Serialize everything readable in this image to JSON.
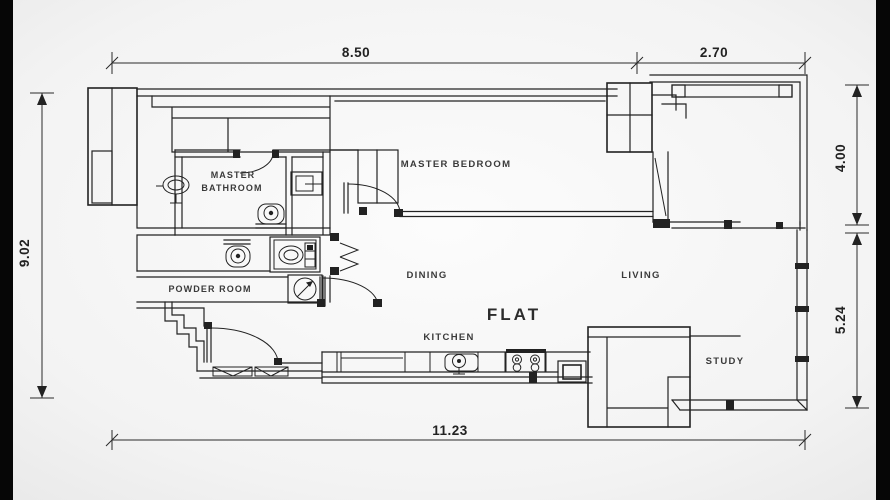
{
  "plan": {
    "title": "FLAT",
    "rooms": {
      "master_bedroom": "MASTER BEDROOM",
      "master_bathroom_line1": "MASTER",
      "master_bathroom_line2": "BATHROOM",
      "powder_room": "POWDER ROOM",
      "dining": "DINING",
      "living": "LIVING",
      "kitchen": "KITCHEN",
      "study": "STUDY"
    },
    "dims": {
      "top": "8.50",
      "balcony_top": "2.70",
      "left": "9.02",
      "right_upper": "4.00",
      "right_lower": "5.24",
      "bottom": "11.23"
    },
    "fixtures": [
      "pedestal-sink",
      "toilet",
      "toilet",
      "shower-unit",
      "washing-machine",
      "dryer",
      "bifold-door",
      "kitchen-sink",
      "stove",
      "study-desk"
    ],
    "colors": {
      "line": "#222222",
      "background": "#f2f2f2",
      "paper_center": "#fbfbfb",
      "letterbox": "#060606",
      "text": "#3a3a3a"
    }
  }
}
